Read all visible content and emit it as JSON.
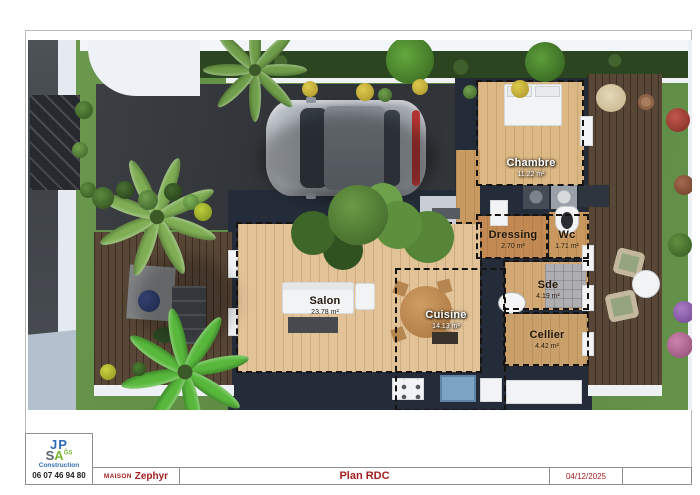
{
  "title_block": {
    "logo": {
      "line1": "JP",
      "line2_s": "S",
      "line2_a": "A",
      "suffix": "ĜS",
      "subtitle": "Construction",
      "phone": "06 07 46 94 80"
    },
    "project_label": "MAISON",
    "project_name": "Zephyr",
    "sheet_title": "Plan RDC",
    "date": "04/12/2025",
    "accent_color": "#a32020"
  },
  "plan": {
    "rooms": [
      {
        "id": "chambre",
        "name": "Chambre",
        "area": "11.22 m²"
      },
      {
        "id": "dressing",
        "name": "Dressing",
        "area": "2.70 m²"
      },
      {
        "id": "wc",
        "name": "Wc",
        "area": "1.71 m²"
      },
      {
        "id": "sde",
        "name": "Sde",
        "area": "4.19 m²"
      },
      {
        "id": "cellier",
        "name": "Cellier",
        "area": "4.42 m²"
      },
      {
        "id": "salon",
        "name": "Salon",
        "area": "23.78 m²"
      },
      {
        "id": "cuisine",
        "name": "Cuisine",
        "area": "14.13 m²"
      }
    ]
  }
}
